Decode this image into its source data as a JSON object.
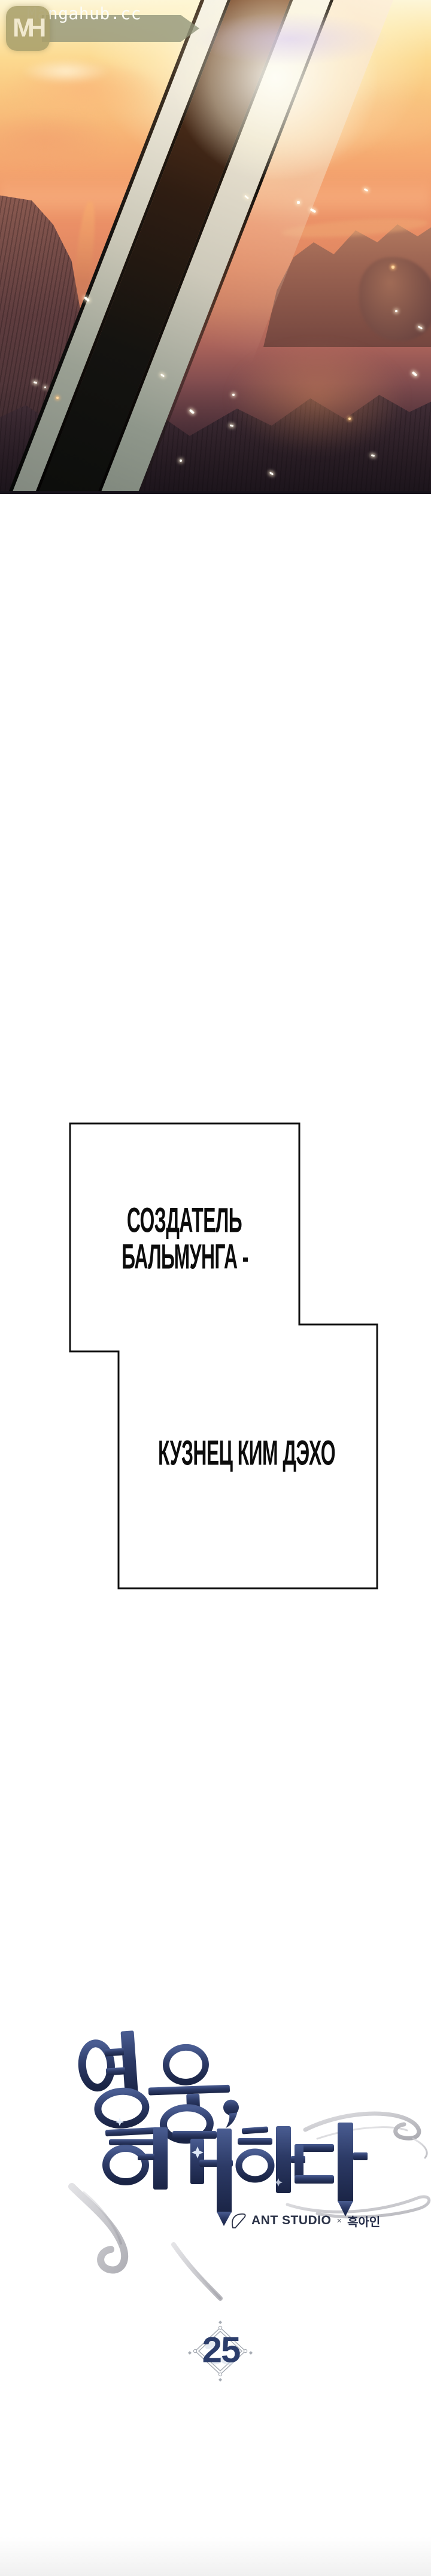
{
  "watermark": {
    "logo_monogram": "MH",
    "site_name": "Mangahub.cc",
    "logo_bg": "#a89f6b",
    "banner_bg": "#8f9478",
    "text_color": "#fcfcf6"
  },
  "bubbles": [
    {
      "lines": [
        "СОЗДАТЕЛЬ",
        "БАЛЬМУНГА -"
      ]
    },
    {
      "lines": [
        "КУЗНЕЦ КИМ ДЭХО"
      ]
    }
  ],
  "title": {
    "text": "영웅, 회귀하다",
    "color_top": "#4a5d92",
    "color_bottom": "#1a2445",
    "flourish_color": "#a8a8b0"
  },
  "credits": {
    "studio": "ANT STUDIO",
    "separator": "×",
    "author": "흑아인"
  },
  "chapter": {
    "number": "25",
    "accent": "#2c3d6b",
    "ornament": "#a6abb3"
  },
  "art_colors": {
    "sky_top": "#fdf6d8",
    "sky_mid": "#f29d6c",
    "rocks_dark": "#241c24",
    "blade_core": "#2f1d12",
    "blade_edge": "#efe9da"
  }
}
